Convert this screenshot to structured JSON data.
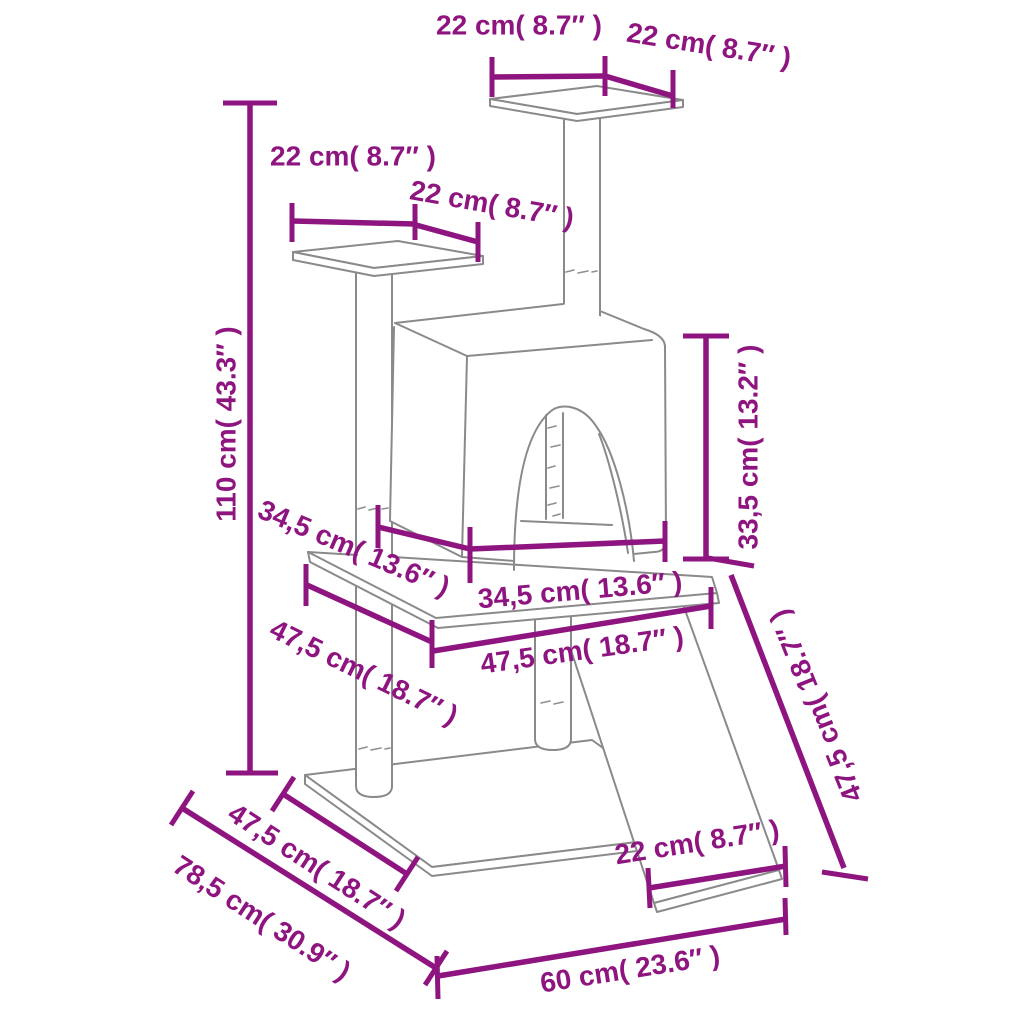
{
  "diagram": {
    "type": "product-dimension-diagram",
    "units": "cm and inches"
  },
  "colors": {
    "dimension_accent": "#8e1480",
    "product_outline": "#8a8a8a",
    "background": "#ffffff"
  },
  "dims": {
    "top_platform_width": "22 cm( 8.7″ )",
    "top_platform_depth": "22 cm( 8.7″ )",
    "left_platform_width": "22 cm( 8.7″ )",
    "left_platform_depth": "22 cm( 8.7″ )",
    "total_height": "110 cm( 43.3″ )",
    "house_depth": "34,5 cm( 13.6″ )",
    "house_width": "34,5 cm( 13.6″ )",
    "mid_platform_depth": "47,5 cm( 18.7″ )",
    "mid_platform_width": "47,5 cm( 18.7″ )",
    "house_height": "33,5 cm( 13.2″ )",
    "ramp_length": "47,5 cm( 18.7″ )",
    "ramp_width": "22 cm( 8.7″ )",
    "base_width": "60 cm( 23.6″ )",
    "base_depth": "47,5 cm( 18.7″ )",
    "footprint_depth": "78,5 cm( 30.9″ )"
  }
}
